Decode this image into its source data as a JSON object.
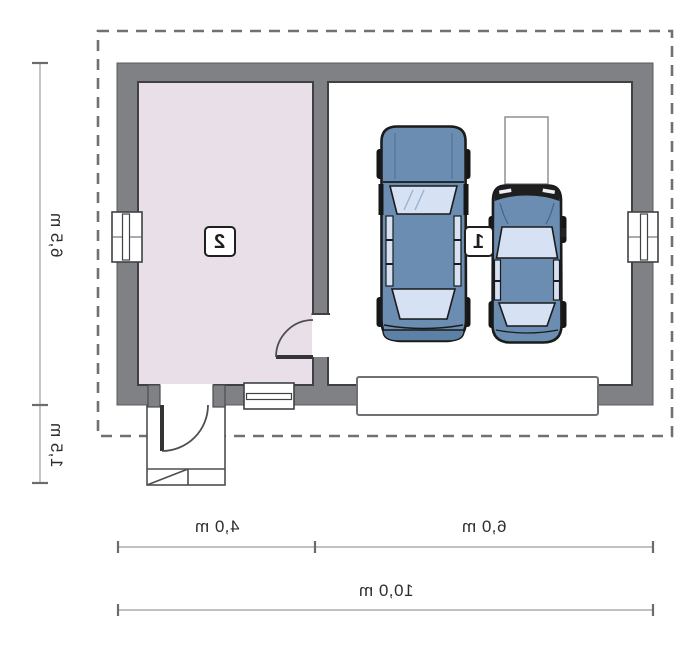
{
  "plan": {
    "type": "garage-floor-plan",
    "labels": {
      "room1": "1",
      "room2": "2"
    },
    "dimensions": {
      "depth_main": "6,5 m",
      "depth_porch": "1,5 m",
      "width_room2": "4,0 m",
      "width_garage": "6,0 m",
      "width_total": "10,0 m"
    },
    "objects": [
      "car-suv-icon",
      "car-sedan-icon",
      "storage-unit",
      "entry-steps",
      "window",
      "door"
    ],
    "colors": {
      "wall": "#7f8184",
      "room2_floor": "#e8dfe9",
      "garage_floor": "#ffffff",
      "outline": "#3f4144",
      "car_body": "#6b8db1",
      "car_glass": "#d6e2f3",
      "dashed_roof": "#6f7173",
      "dimension_line": "#9a9c9e",
      "text": "#2d2d2d"
    }
  }
}
